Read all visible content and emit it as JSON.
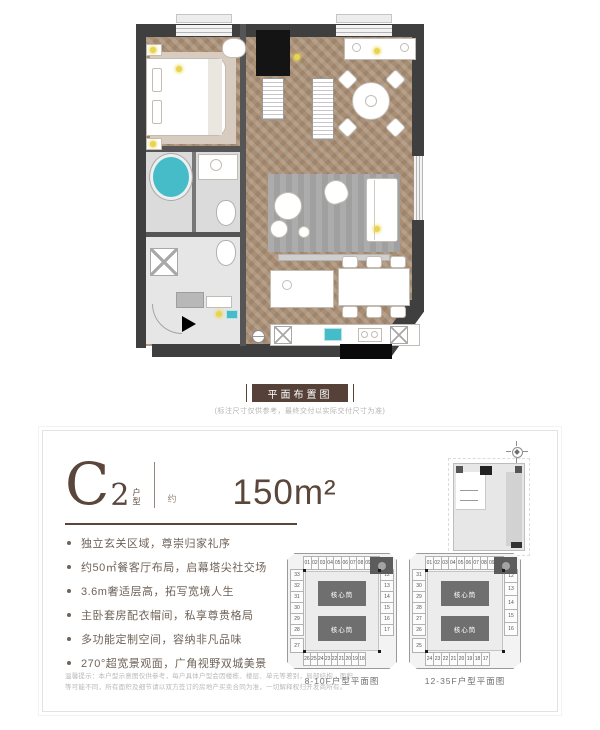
{
  "colors": {
    "wall": "#3f3f3f",
    "wood": "#a98e74",
    "brand-brown": "#5a463a",
    "label-bg": "#564139",
    "feature-text": "#6f635a",
    "accent-yellow": "#e8d44d",
    "teal": "#45bcc7",
    "core-gray": "#6f6f6f",
    "plate-bg": "#f3f3f3"
  },
  "plan": {
    "label": "平面布置图",
    "note": "(标注尺寸仅供参考，最终交付以实际交付尺寸为准)"
  },
  "card": {
    "unit": {
      "letter": "C",
      "number": "2",
      "suffix_top": "户",
      "suffix_bottom": "型",
      "approx": "约",
      "area": "150m²"
    },
    "features": [
      "独立玄关区域，尊崇归家礼序",
      "约50㎡餐客厅布局，启幕塔尖社交场",
      "3.6m奢适层高，拓写宽境人生",
      "主卧套房配衣帽间，私享尊贵格局",
      "多功能定制空间，容纳非凡品味",
      "270°超宽景观面，广角视野双城美景"
    ],
    "disclaimer_line1": "温馨提示：本户型示意图仅供参考，每户具体户型会因楼栋、楼层、单元等差别，局部结构、面积",
    "disclaimer_line2": "等可能不同，所有面积及细节请以双方签订的房地产买卖合同为准，一切解释权归开发商所有。",
    "diagrams": [
      {
        "caption": "8-10F户型平面图",
        "core_label": "核心筒",
        "top_row": [
          "01",
          "02",
          "03",
          "04",
          "05",
          "06",
          "07",
          "08",
          "09",
          "10"
        ],
        "left_col": [
          "33",
          "32",
          "31",
          "30",
          "29",
          "28"
        ],
        "corner": "27",
        "bottom_row": [
          "26",
          "25",
          "24",
          "23",
          "22",
          "21",
          "20",
          "19",
          "18"
        ],
        "right_col": [
          "12",
          "13",
          "14",
          "15",
          "16",
          "17"
        ]
      },
      {
        "caption": "12-35F户型平面图",
        "core_label": "核心筒",
        "top_row": [
          "01",
          "02",
          "03",
          "04",
          "05",
          "06",
          "07",
          "08",
          "09",
          "10"
        ],
        "left_col": [
          "31",
          "30",
          "29",
          "28",
          "27",
          "26"
        ],
        "corner": "25",
        "bottom_row": [
          "24",
          "23",
          "22",
          "21",
          "20",
          "19",
          "18",
          "17"
        ],
        "right_col": [
          "12",
          "13",
          "14",
          "15",
          "16"
        ]
      }
    ]
  }
}
